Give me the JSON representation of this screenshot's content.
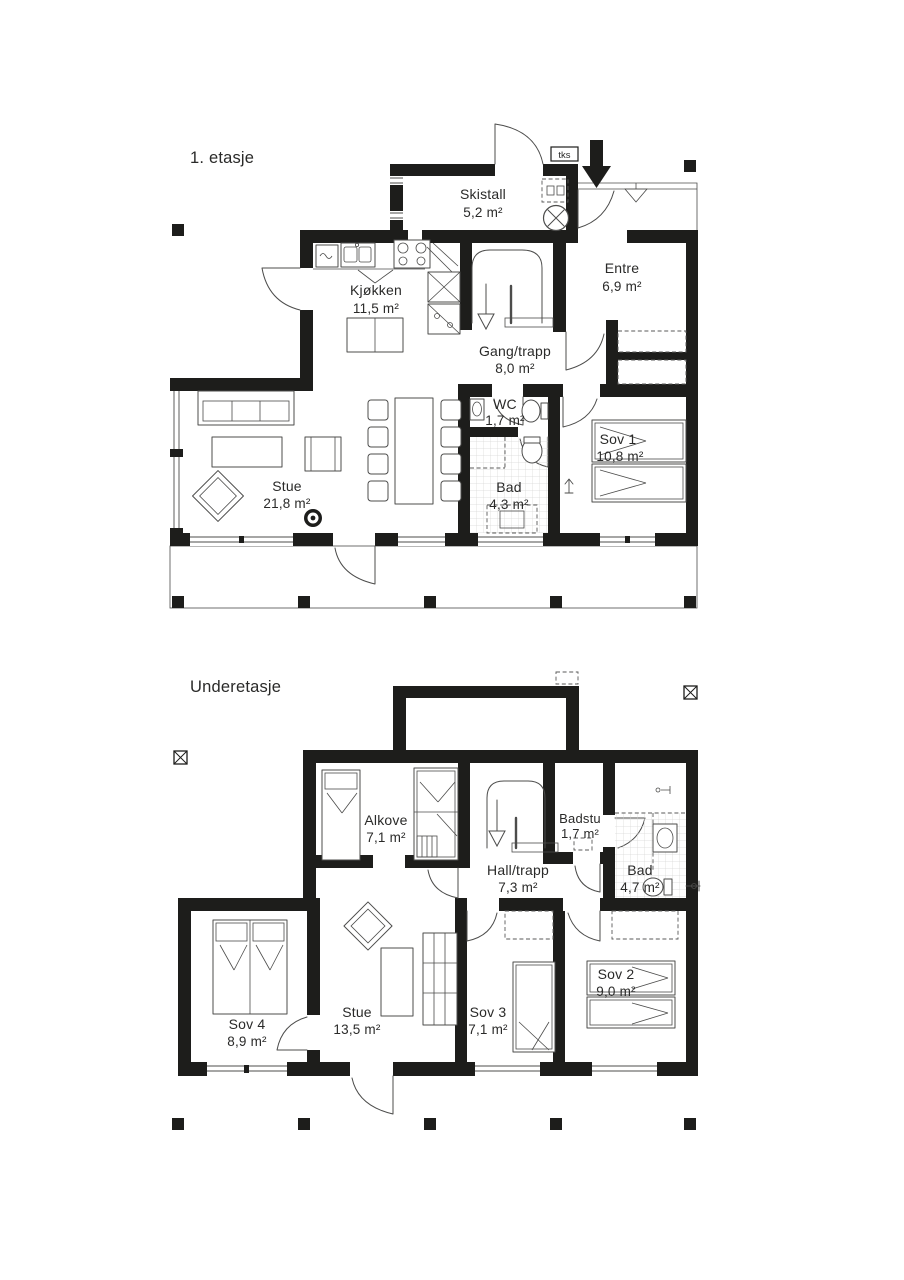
{
  "colors": {
    "wall": "#1d1d1b",
    "thin_line": "#4c4c4b",
    "text": "#2a2a29",
    "background": "#ffffff"
  },
  "floor1": {
    "title": "1. etasje",
    "tks_label": "tks",
    "rooms": {
      "skistall": {
        "name": "Skistall",
        "area": "5,2 m²"
      },
      "entre": {
        "name": "Entre",
        "area": "6,9 m²"
      },
      "kjokken": {
        "name": "Kjøkken",
        "area": "11,5 m²"
      },
      "gang": {
        "name": "Gang/trapp",
        "area": "8,0 m²"
      },
      "wc": {
        "name": "WC",
        "area": "1,7 m²"
      },
      "bad": {
        "name": "Bad",
        "area": "4,3 m²"
      },
      "sov1": {
        "name": "Sov 1",
        "area": "10,8 m²"
      },
      "stue": {
        "name": "Stue",
        "area": "21,8 m²"
      }
    }
  },
  "floor2": {
    "title": "Underetasje",
    "rooms": {
      "alkove": {
        "name": "Alkove",
        "area": "7,1 m²"
      },
      "hall": {
        "name": "Hall/trapp",
        "area": "7,3 m²"
      },
      "badstu": {
        "name": "Badstu",
        "area": "1,7 m²"
      },
      "bad": {
        "name": "Bad",
        "area": "4,7 m²"
      },
      "sov4": {
        "name": "Sov 4",
        "area": "8,9 m²"
      },
      "stue": {
        "name": "Stue",
        "area": "13,5 m²"
      },
      "sov3": {
        "name": "Sov 3",
        "area": "7,1 m²"
      },
      "sov2": {
        "name": "Sov 2",
        "area": "9,0 m²"
      }
    }
  }
}
